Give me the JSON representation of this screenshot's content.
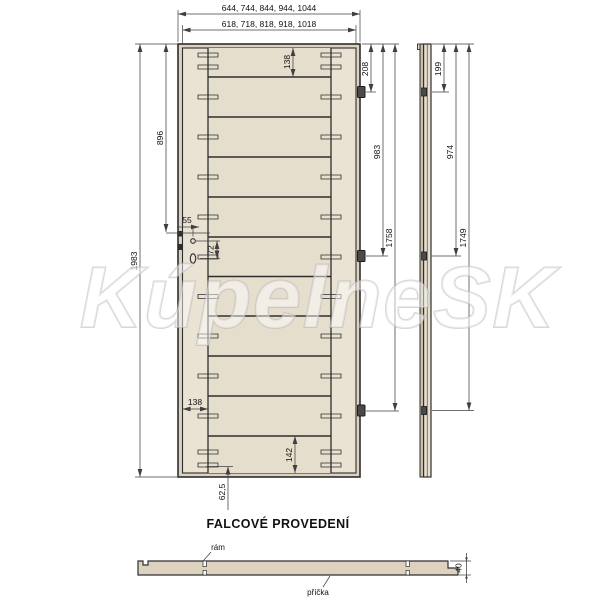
{
  "watermark": "KúpelneSK",
  "title": "FALCOVÉ PROVEDENÍ",
  "front_view": {
    "dim_outer_widths": "644, 744, 844, 944, 1044",
    "dim_inner_widths": "618, 718, 818, 918, 1018",
    "dim_height": "1983",
    "dim_lock_height": "896",
    "dim_lock_offset": "55",
    "dim_lock_spacing": "72",
    "dim_top_rail": "138",
    "dim_stile_width": "138",
    "dim_bottom_rail": "142",
    "dim_bottom_dowel": "62,5",
    "hinge_dims": [
      "208",
      "983",
      "1758"
    ]
  },
  "side_view": {
    "hinge_dims": [
      "199",
      "974",
      "1749"
    ]
  },
  "section_view": {
    "label_frame": "rám",
    "label_crossbar": "příčka",
    "dim_thickness": "40"
  },
  "colors": {
    "door_leaf": "#eae2d2",
    "door_edge": "#dcd2bf",
    "door_panel": "#e6decd",
    "side_band": "#c9bda7",
    "side_body": "#e7dfcf",
    "section_fill": "#ddd2bf",
    "line": "#2e2e2e",
    "dim_line": "#3f3f3f",
    "watermark_gray": "#b7b7b7"
  }
}
